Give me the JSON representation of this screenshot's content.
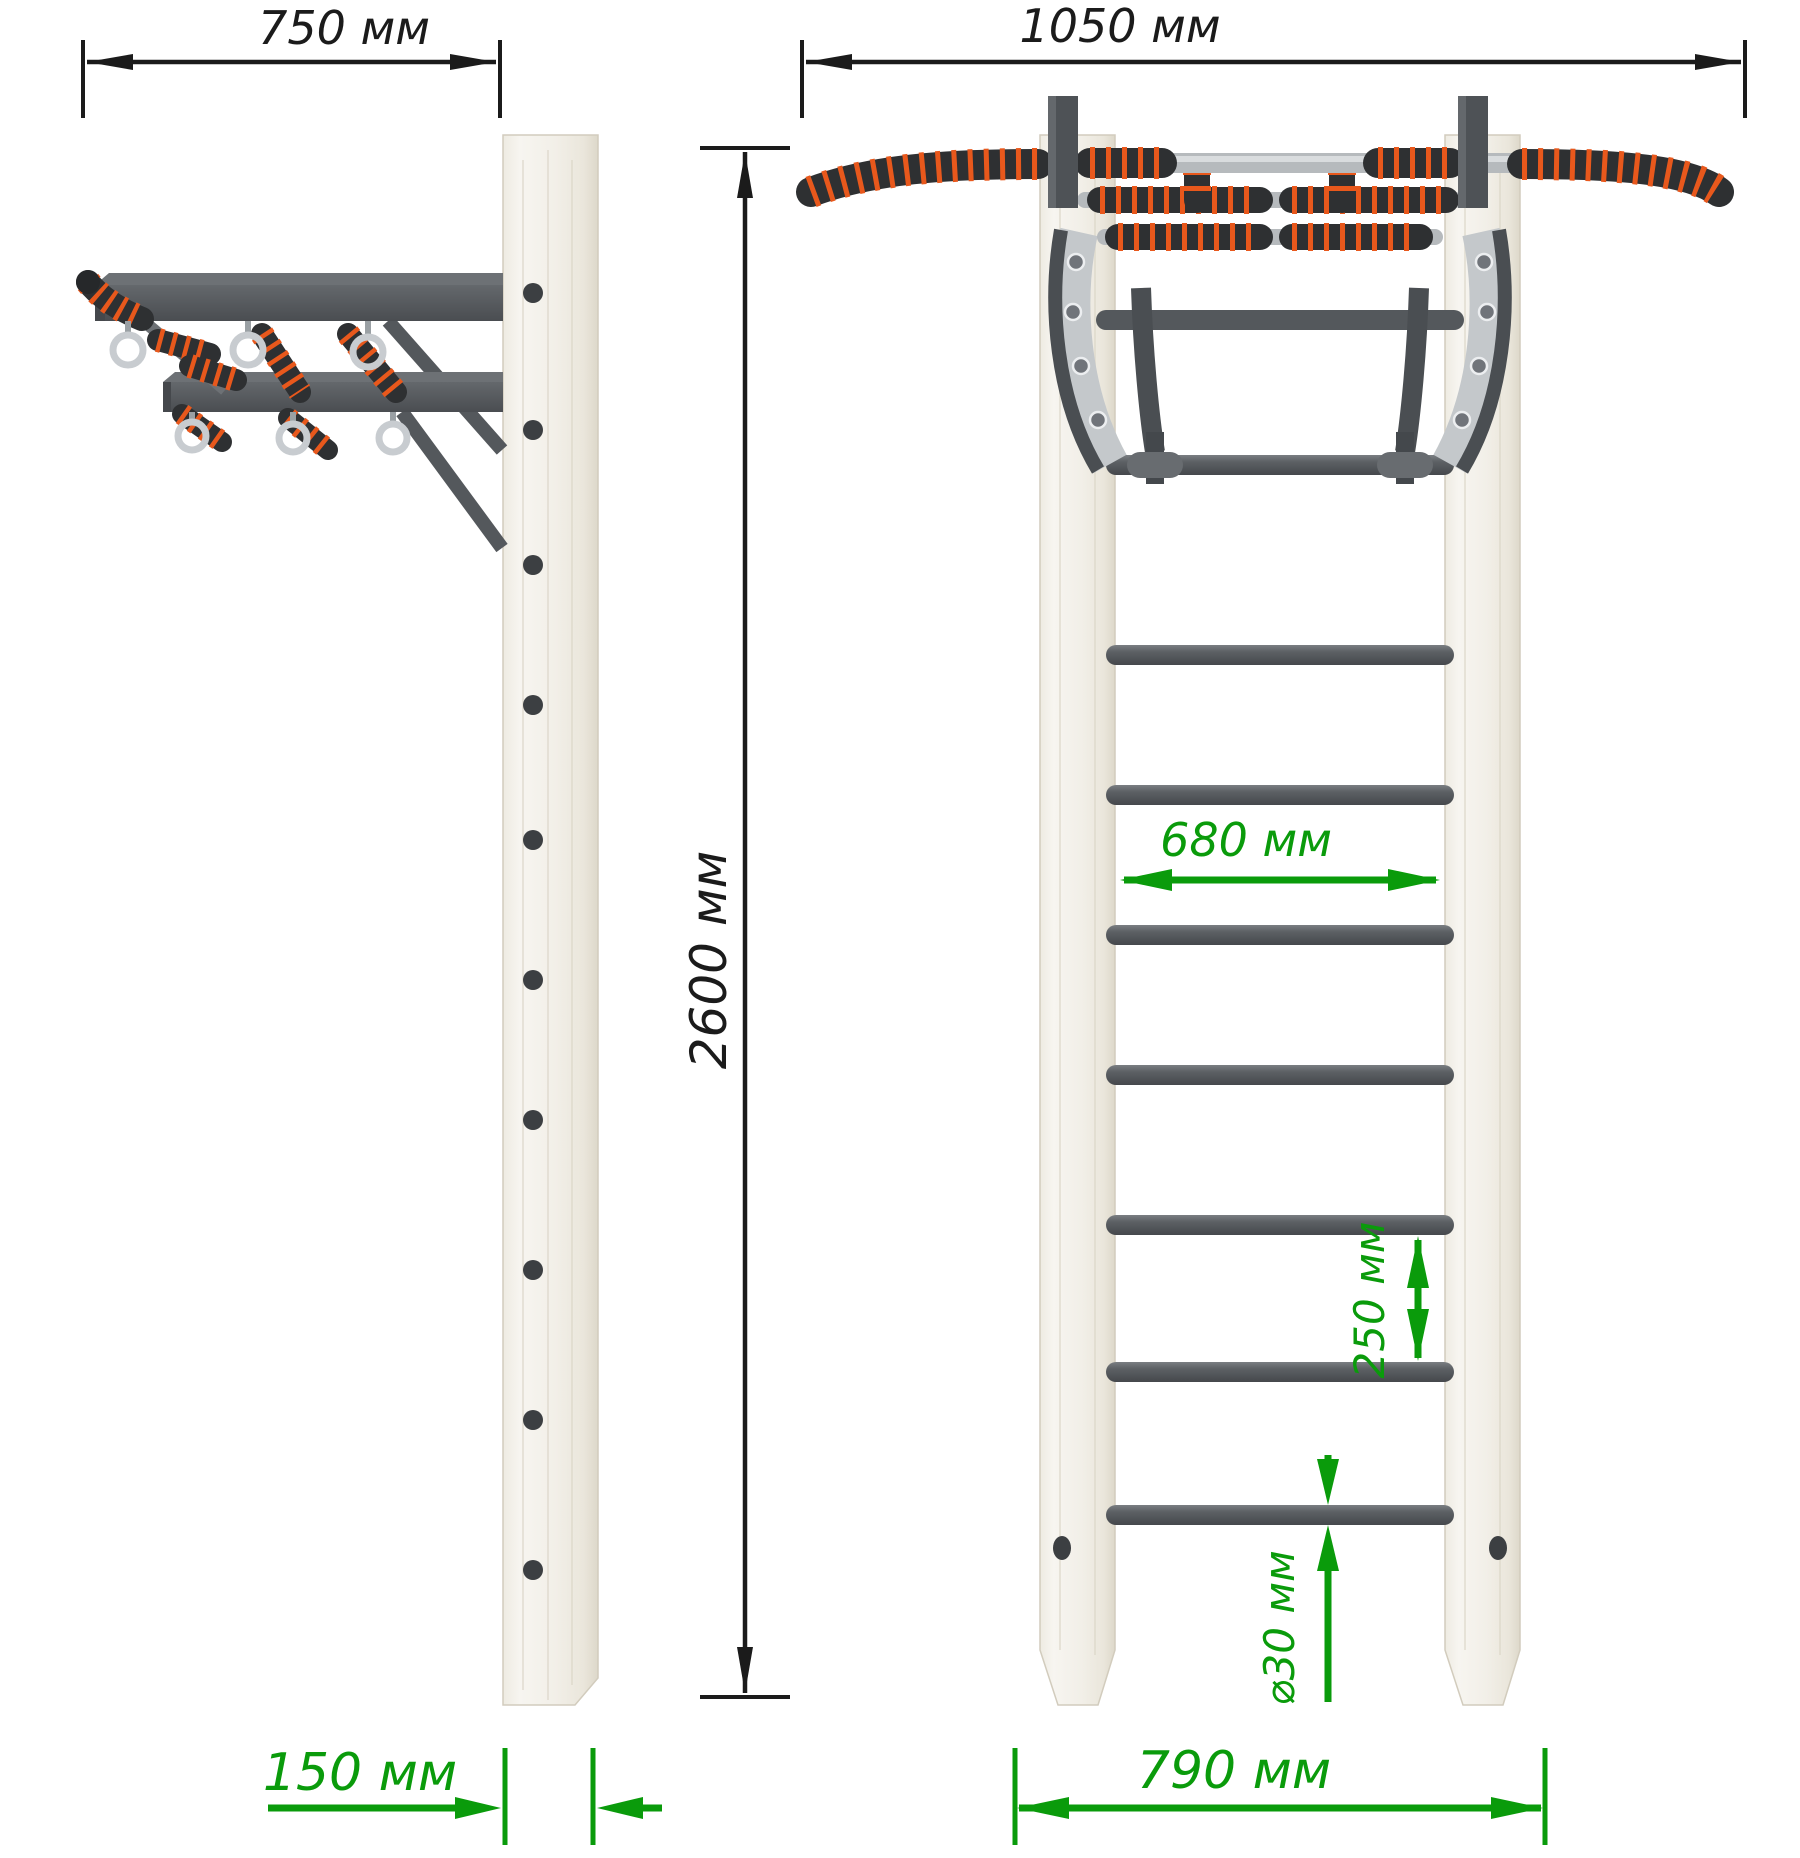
{
  "dimensions": {
    "depth_overall": "750 мм",
    "width_overall": "1050 мм",
    "height_overall": "2600 мм",
    "inner_width": "680 мм",
    "rung_spacing": "250 мм",
    "rung_diameter": "⌀30 мм",
    "post_depth": "150 мм",
    "ladder_width": "790 мм"
  },
  "colors": {
    "dimension_black": "#1b1b1b",
    "dimension_green": "#0a9b0b",
    "metal_dark": "#54585c",
    "metal_chrome": "#b6babd",
    "grip_black": "#2e3032",
    "grip_orange": "#e8581c",
    "wood_light": "#f3f0e9",
    "ring_silver": "#c8ccd0"
  }
}
